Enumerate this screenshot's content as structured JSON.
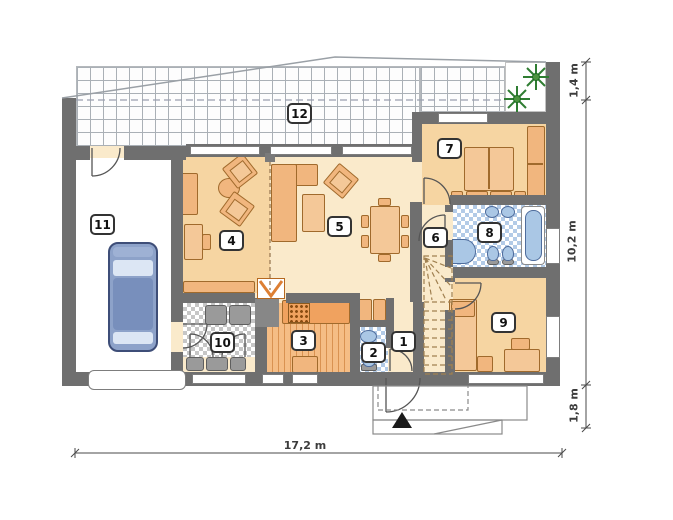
{
  "room_labels": {
    "r1": "1",
    "r2": "2",
    "r3": "3",
    "r4": "4",
    "r5": "5",
    "r6": "6",
    "r7": "7",
    "r8": "8",
    "r9": "9",
    "r10": "10",
    "r11": "11",
    "r12": "12"
  },
  "dimensions": {
    "bottom": "17,2 m",
    "right_top": "1,4 m",
    "right_middle": "10,2 m",
    "right_bottom": "1,8 m"
  },
  "colors": {
    "wall": "#6f6f6f",
    "floor_main": "#faeacb",
    "floor_warm": "#f6d5a2",
    "furniture_orange": "#f1b67e",
    "kitchen_counter": "#f0a25f",
    "fixture_blue": "#aac7e5",
    "car_blue": "#8da2c9",
    "plant_green": "#2f7d32",
    "bath_tile": "#b3cbe7",
    "utility_tile": "#c6c6c6"
  },
  "icons": {
    "plant": "terrace-plant",
    "entrance_marker": "entrance-triangle"
  }
}
